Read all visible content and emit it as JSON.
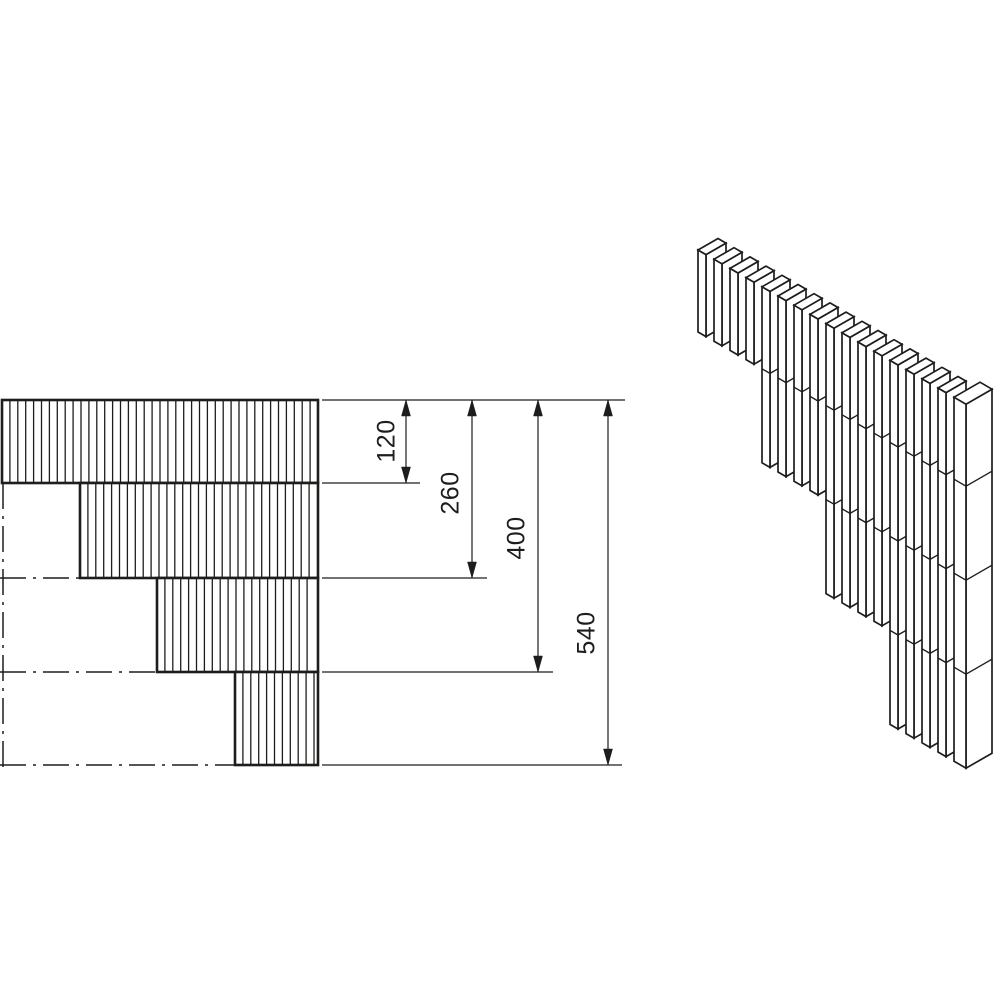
{
  "colors": {
    "background": "#ffffff",
    "line": "#1d1d1b"
  },
  "elevation_view": {
    "bands": [
      {
        "x": 2,
        "y": 400,
        "w": 316,
        "h": 83
      },
      {
        "x": 80,
        "y": 483,
        "w": 238,
        "h": 95
      },
      {
        "x": 157,
        "y": 578,
        "w": 161,
        "h": 94
      },
      {
        "x": 235,
        "y": 672,
        "w": 83,
        "h": 93
      }
    ],
    "hatch_spacing": 7.9,
    "border_width": 2.6,
    "hatch_width": 1.3,
    "centerlines_horizontal": [
      {
        "y": 578,
        "x1": 0,
        "x2": 80
      },
      {
        "y": 672,
        "x1": 0,
        "x2": 157
      },
      {
        "y": 765,
        "x1": 0,
        "x2": 236
      }
    ],
    "centerline_vertical": {
      "x": 3,
      "y1": 483,
      "y2": 768
    },
    "centerline_dash": "26 7 3 7"
  },
  "dimensions": {
    "font_size": 25,
    "arrow": {
      "length": 16,
      "half_width": 4.5
    },
    "extension_lines": [
      {
        "y": 400,
        "x1": 322,
        "x2": 625
      },
      {
        "y": 483,
        "x1": 322,
        "x2": 420
      },
      {
        "y": 578,
        "x1": 322,
        "x2": 487
      },
      {
        "y": 672,
        "x1": 322,
        "x2": 553
      },
      {
        "y": 765,
        "x1": 322,
        "x2": 622
      }
    ],
    "items": [
      {
        "label": "120",
        "x": 406,
        "y1": 400,
        "y2": 483,
        "label_x": 388,
        "label_y": 441
      },
      {
        "label": "260",
        "x": 472,
        "y1": 400,
        "y2": 578,
        "label_x": 452,
        "label_y": 493
      },
      {
        "label": "400",
        "x": 538,
        "y1": 400,
        "y2": 672,
        "label_x": 518,
        "label_y": 538
      },
      {
        "label": "540",
        "x": 608,
        "y1": 400,
        "y2": 765,
        "label_x": 588,
        "label_y": 633
      }
    ]
  },
  "isometric_view": {
    "origin": {
      "x": 698,
      "y": 250
    },
    "pitch": {
      "x": 16,
      "y": 9.2
    },
    "slat_thickness": {
      "x": 8,
      "y": 4.6
    },
    "depth": {
      "x": 20,
      "y": -11.5
    },
    "slat_count": 16,
    "slats_per_step": 4,
    "course_bottom_offsets": [
      82,
      176,
      270,
      364
    ],
    "end_block": {
      "axis_offset": 256,
      "thickness": {
        "x": 12,
        "y": 7
      },
      "depth": {
        "x": 26,
        "y": -15
      },
      "height": 364
    },
    "stroke_width": 1.7,
    "joint_width": 1.4
  }
}
